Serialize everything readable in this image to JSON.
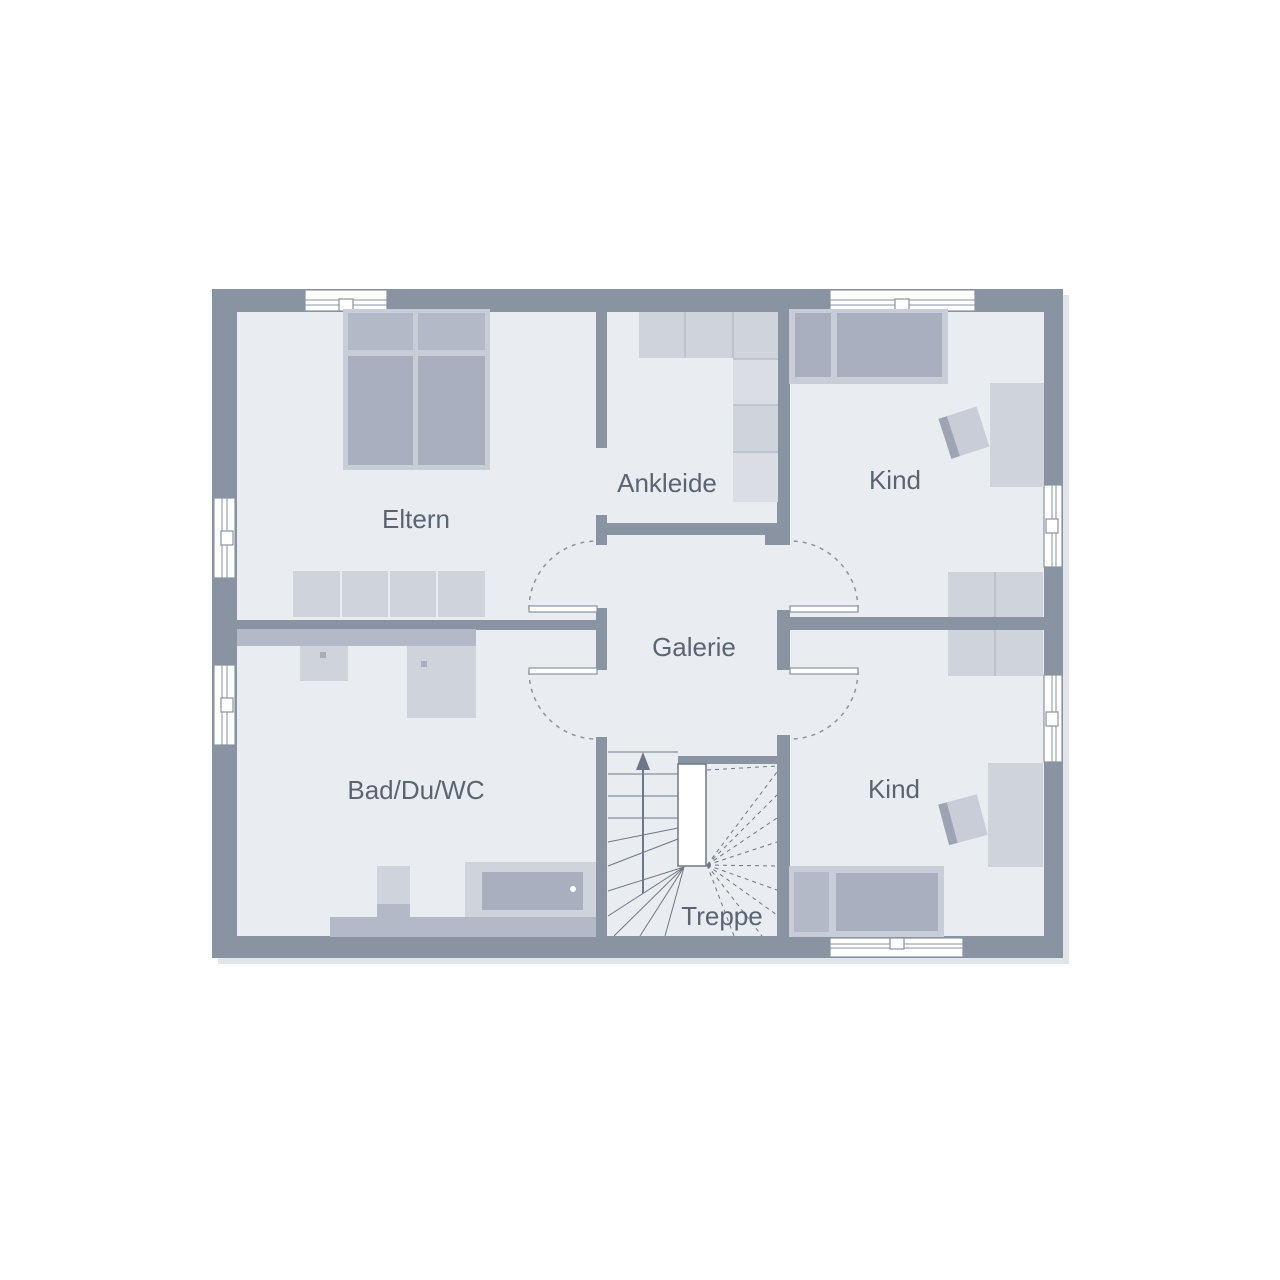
{
  "rooms": {
    "eltern": "Eltern",
    "ankleide": "Ankleide",
    "kind_top": "Kind",
    "galerie": "Galerie",
    "bad": "Bad/Du/WC",
    "kind_bottom": "Kind",
    "treppe": "Treppe"
  },
  "colors": {
    "wall": "#8a93a2",
    "floor": "#e9ecf1",
    "furniture_light": "#cfd3dc",
    "furniture_lighter": "#dadde4",
    "furniture_mid": "#b3b9c6",
    "furniture_dark": "#a9afbf",
    "furniture_frame": "#c9cdd8",
    "chair_back": "#9da4b3",
    "divider": "#b9bfca",
    "stair_line": "#6e7787",
    "label_text": "#5b6472",
    "shadow": "#e2e5ea",
    "window_white": "#ffffff",
    "fixture_dot": "#a7adbc"
  }
}
